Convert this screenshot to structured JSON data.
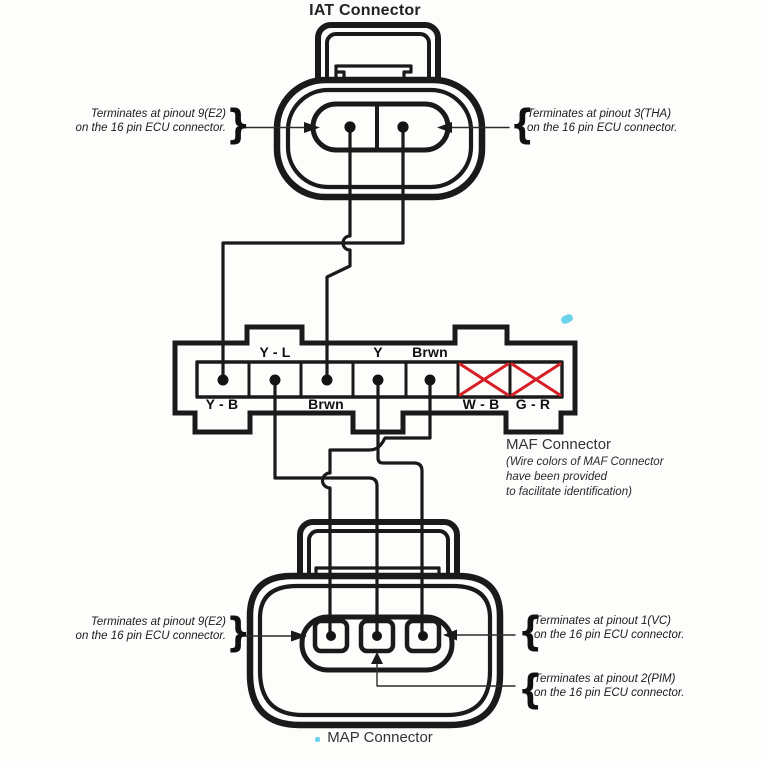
{
  "iat": {
    "title": "IAT Connector"
  },
  "maf": {
    "title": "MAF Connector",
    "note": [
      "(Wire colors of MAF Connector",
      "have been provided",
      "to facilitate identification)"
    ],
    "labels_top": [
      {
        "text": "Y - L"
      },
      {
        "text": "Y"
      },
      {
        "text": "Brwn"
      }
    ],
    "labels_bottom": [
      {
        "text": "Y - B"
      },
      {
        "text": "Brwn"
      },
      {
        "text": "W - B"
      },
      {
        "text": "G - R"
      }
    ]
  },
  "map": {
    "title": "MAP Connector"
  },
  "annotations": {
    "iat_e2": {
      "brace": "}",
      "line1": "Terminates at pinout 9(E2)",
      "line2": "on the 16 pin ECU connector."
    },
    "iat_tha": {
      "brace": "{",
      "line1": "Terminates at pinout 3(THA)",
      "line2": "on the 16 pin ECU connector."
    },
    "map_e2": {
      "brace": "}",
      "line1": "Terminates at pinout 9(E2)",
      "line2": "on the 16 pin ECU connector."
    },
    "map_vc": {
      "brace": "{",
      "line1": "Terminates at pinout 1(VC)",
      "line2": "on the 16 pin ECU connector."
    },
    "map_pim": {
      "brace": "{",
      "line1": "Terminates at pinout 2(PIM)",
      "line2": "on the 16 pin ECU connector."
    }
  },
  "colors": {
    "line": "#1a1a1a",
    "red_x": "#d61f26",
    "paper": "#fdfdfb",
    "artifact": "#49c8e6"
  }
}
